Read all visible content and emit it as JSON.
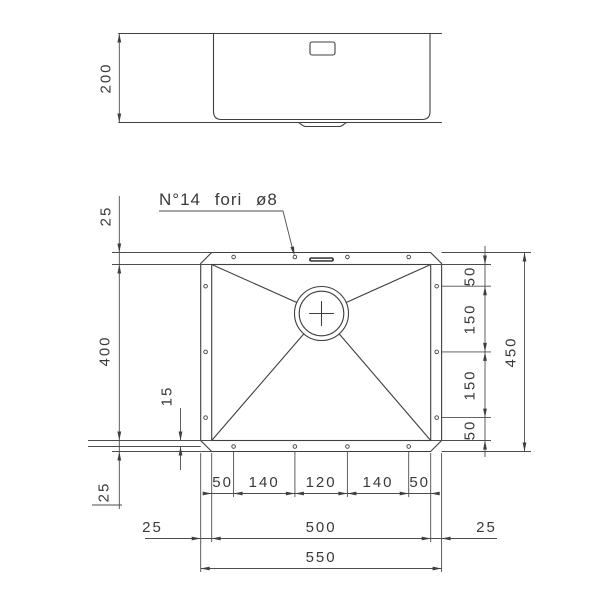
{
  "annotation": {
    "holes_note": "N°14 fori ø8"
  },
  "side_view": {
    "depth": "200"
  },
  "plan_view": {
    "left": {
      "rim_top": "25",
      "bowl_height": "400",
      "hole_inset": "15",
      "rim_bottom": "25"
    },
    "right": {
      "segments": [
        "50",
        "150",
        "150",
        "50"
      ],
      "overall_height": "450"
    },
    "bottom": {
      "hole_spacing": [
        "50",
        "140",
        "120",
        "140",
        "50"
      ],
      "rim_left": "25",
      "bowl_width": "500",
      "rim_right": "25",
      "overall_width": "550"
    }
  },
  "colors": {
    "line": "#3f3f3f",
    "dim": "#4d4d4d",
    "background": "#ffffff"
  }
}
